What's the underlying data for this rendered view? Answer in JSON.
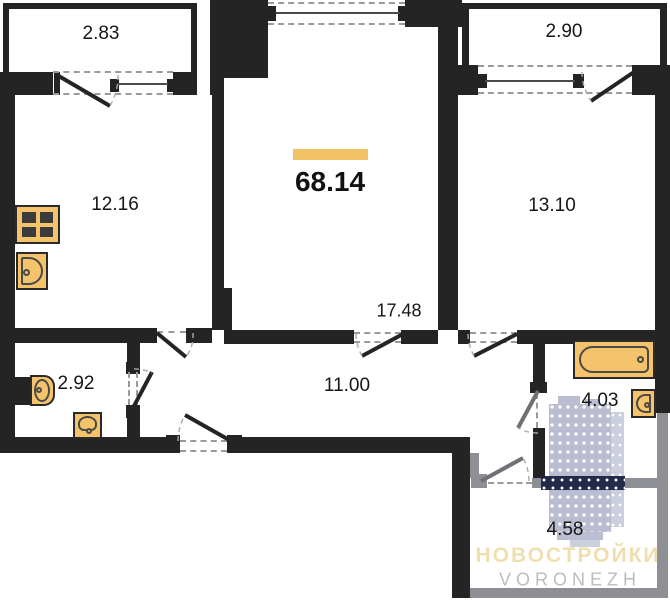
{
  "floor_plan": {
    "total_area_label": "68.14",
    "room_areas": {
      "balcony_left": "2.83",
      "kitchen": "12.16",
      "balcony_right": "2.90",
      "bedroom": "13.10",
      "living_room": "17.48",
      "hallway": "11.00",
      "wc": "2.92",
      "bathroom": "4.03",
      "storage": "4.58"
    },
    "watermark": {
      "title": "НОВОСТРОЙКИ",
      "subtitle": "VORONEZH"
    },
    "icons": {
      "stove": "grid-of-4-burners",
      "kitchen_sink": "rounded-basin-with-drain",
      "toilet": "tank-and-bowl",
      "washbasin": "arched-basin-with-drain",
      "bathtub": "rounded-tub-with-drain",
      "bath_sink": "rounded-basin-with-drain",
      "watermark_building": "dotted-highrise-tower"
    },
    "colors": {
      "wall": "#242424",
      "gray_wall": "#8e8e95",
      "dash": "#9a9a9a",
      "accent_bar": "#f2c364",
      "fixture_fill": "#f4c36b",
      "fixture_stroke": "#2a2a2a",
      "door_gray": "#6f6f74",
      "watermark_building": "#b6bacd",
      "watermark_building_side": "#c9cdda",
      "watermark_band": "#1b2344",
      "watermark_title_color": "#f0dfae",
      "watermark_subtitle_color": "#bcbcbc"
    }
  }
}
